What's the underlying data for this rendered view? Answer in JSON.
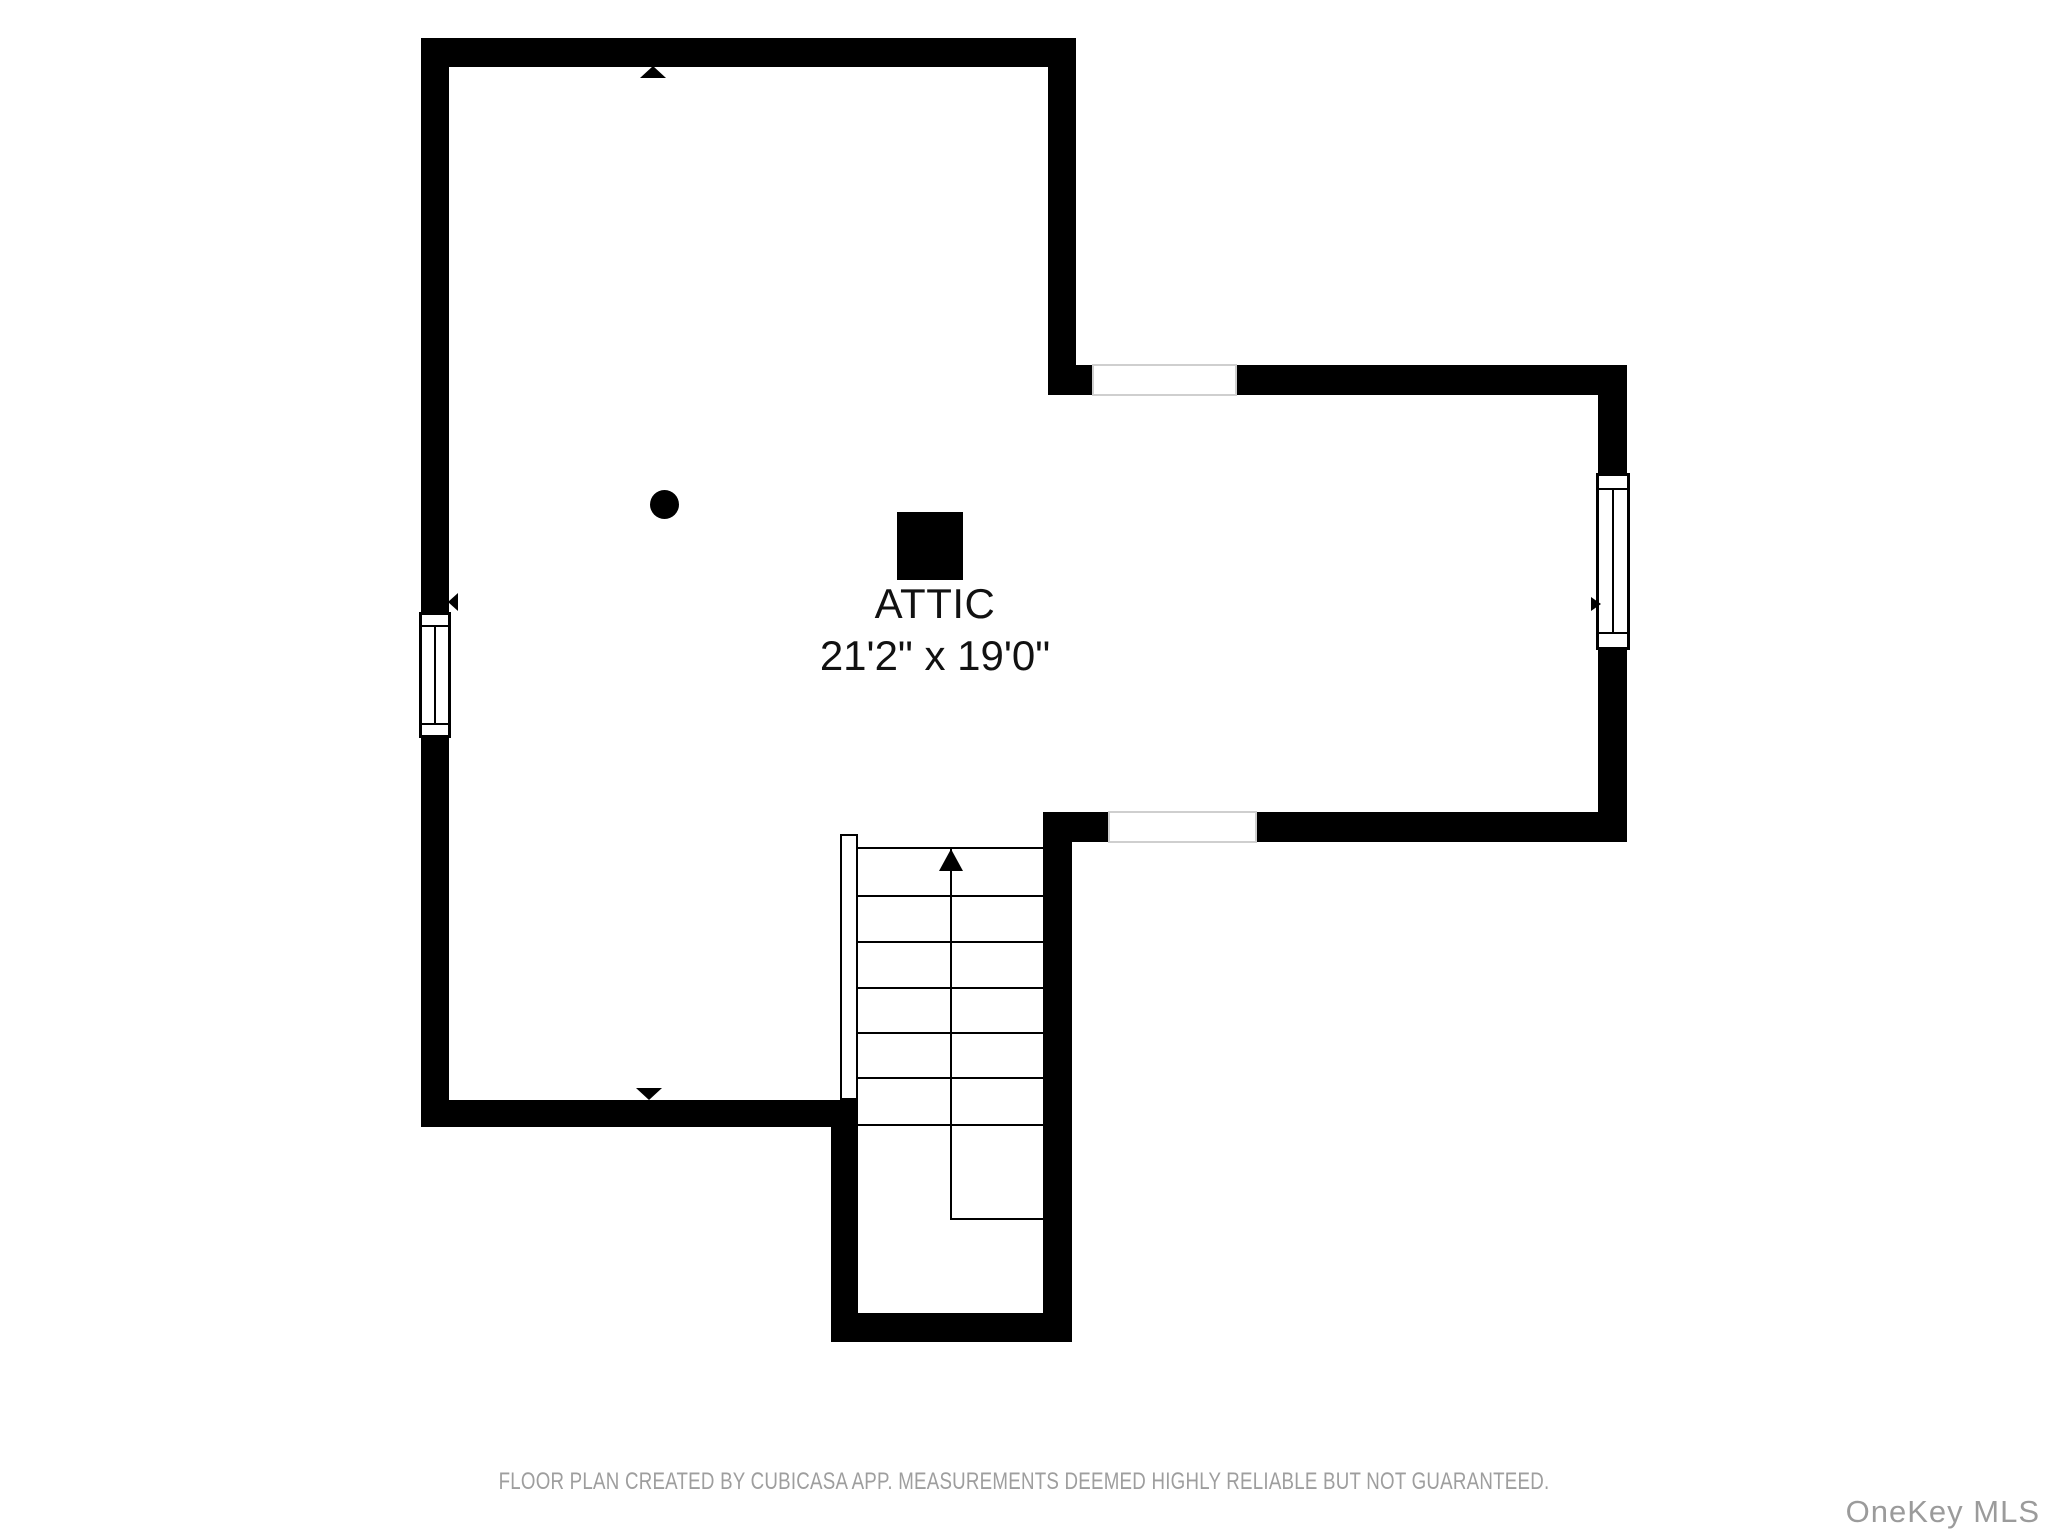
{
  "floor_plan": {
    "room": {
      "name": "ATTIC",
      "dimensions": "21'2\" x 19'0\""
    },
    "stairs": {
      "direction": "up",
      "full_treads": 7,
      "half_treads": 1
    },
    "symbols": {
      "window_count": 2,
      "door_opening_count": 2,
      "icons": [
        "ceiling-square-icon",
        "ceiling-dot-icon",
        "stairs-up-arrow-icon",
        "north-arrow-icon",
        "south-arrow-icon",
        "window-left-arrow-icon",
        "window-right-arrow-icon"
      ]
    },
    "footer": {
      "disclaimer": "FLOOR PLAN CREATED BY CUBICASA APP. MEASUREMENTS DEEMED HIGHLY RELIABLE BUT NOT GUARANTEED.",
      "watermark": "OneKey MLS"
    },
    "colors": {
      "wall": "#000000",
      "background": "#ffffff",
      "room_text": "#111111",
      "footer_text": "#9e9e9e",
      "opening_outline": "#cfcfcf"
    }
  }
}
